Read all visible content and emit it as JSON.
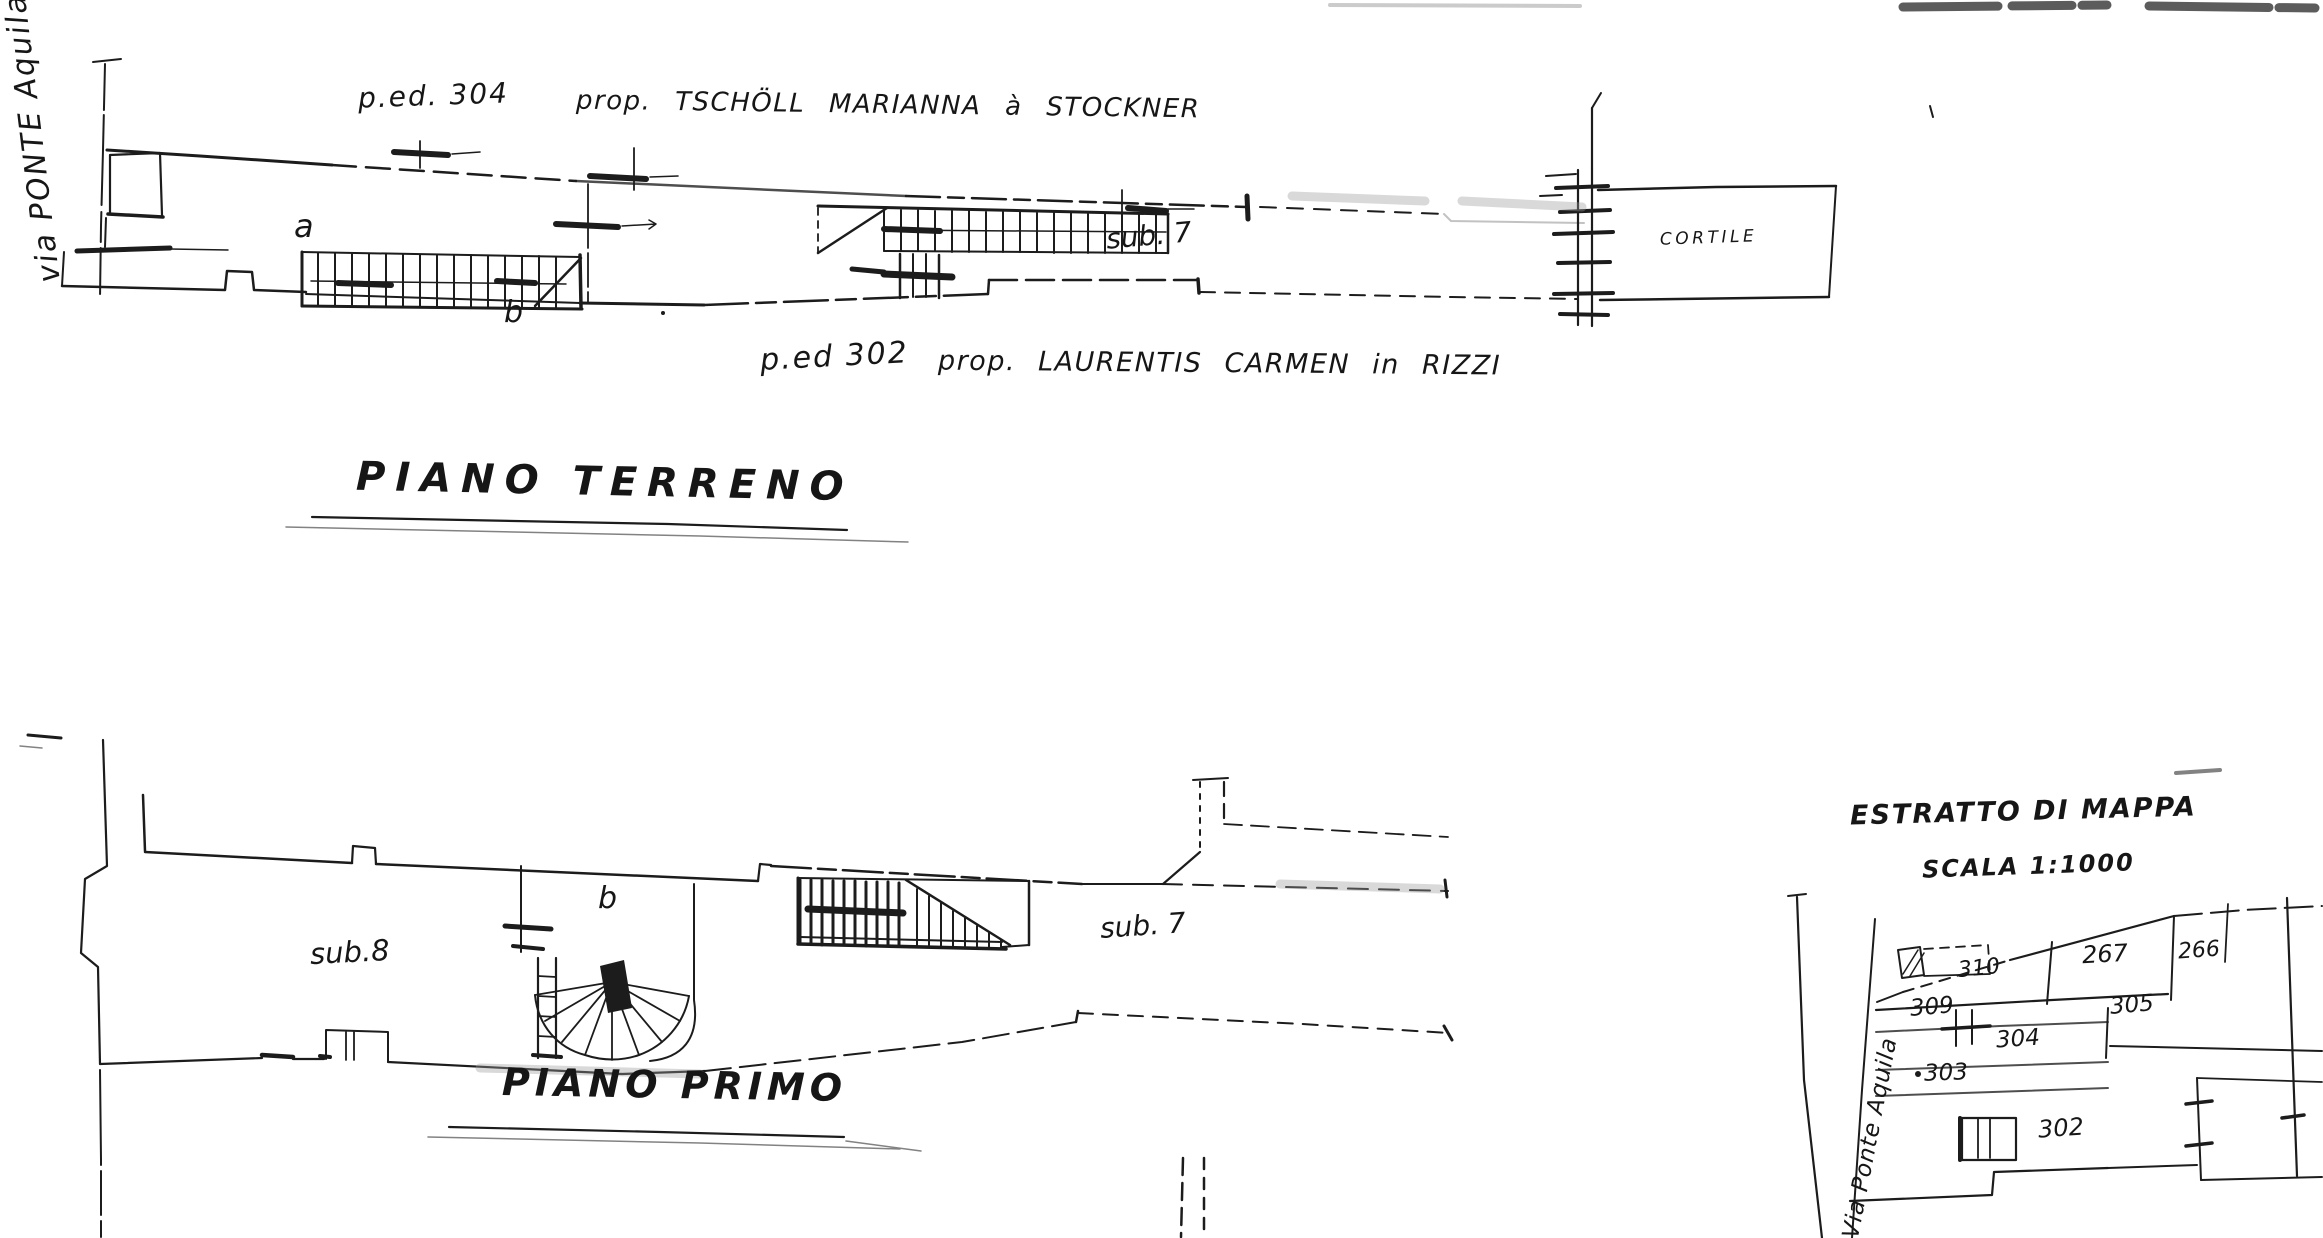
{
  "drawing": {
    "ink": "#1c1c1c",
    "paper": "#ffffff"
  },
  "street": {
    "label": "via PONTE Aquila"
  },
  "annotations": {
    "top": {
      "parcel": "p.ed. 304",
      "owner": "prop. TSCHÖLL MARIANNA à STOCKNER"
    },
    "middle": {
      "parcel": "p.ed 302",
      "owner": "prop. LAURENTIS CARMEN in RIZZI"
    }
  },
  "ground_floor": {
    "title": "PIANO TERRENO",
    "room_a": "a",
    "room_b": "b",
    "unit": "sub. 7",
    "courtyard": "CORTILE"
  },
  "first_floor": {
    "title": "PIANO PRIMO",
    "unit_left": "sub.8",
    "room_b": "b",
    "unit_right": "sub. 7"
  },
  "map": {
    "title": "ESTRATTO DI MAPPA",
    "scale": "SCALA 1:1000",
    "street": "Via Ponte Aquila",
    "parcels": [
      {
        "id": "310"
      },
      {
        "id": "267"
      },
      {
        "id": "266"
      },
      {
        "id": "309"
      },
      {
        "id": "304"
      },
      {
        "id": "305"
      },
      {
        "id": "303"
      },
      {
        "id": "302"
      }
    ]
  }
}
